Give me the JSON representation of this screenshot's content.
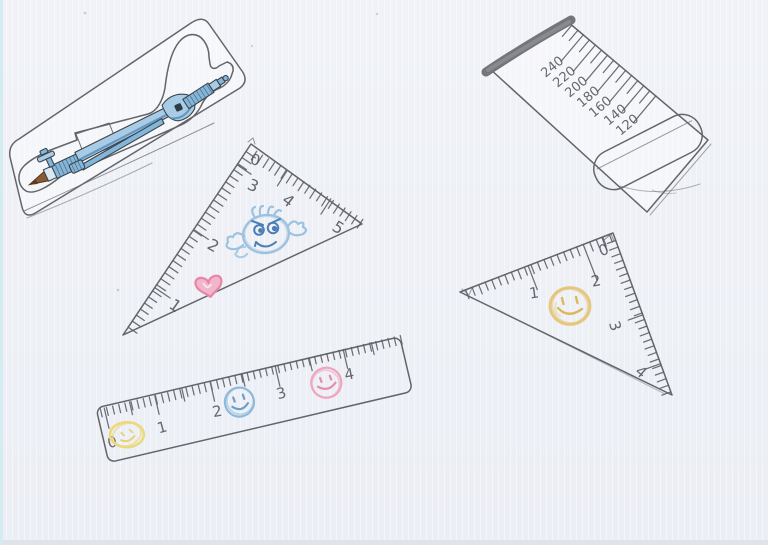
{
  "canvas": {
    "width": 768,
    "height": 545
  },
  "colors": {
    "paper": "#eef0f5",
    "graphite_pencil": "#64646b",
    "compass_blue": "#84b6da",
    "compass_blue_light": "#a9cce6",
    "compass_blue_shade": "#5589b8",
    "pencil_tip_brown": "#8a5a32",
    "roller_edge_gray": "#74747b",
    "doodle_face_blue": "#9cc2e0",
    "doodle_face_blue_dark": "#4a7fb5",
    "heart_pink_stroke": "#e884a8",
    "heart_pink_fill": "#f2b6ca",
    "smiley_orange": "#e4c06a",
    "smiley_yellow": "#ecd97e",
    "smiley_blue": "#8fb9db",
    "smiley_pink": "#efa5be"
  },
  "objects": {
    "roller_ruler": {
      "scale_labels": [
        "240",
        "220",
        "200",
        "180",
        "160",
        "140",
        "120"
      ]
    },
    "left_triangle_ruler": {
      "apex_label": "0",
      "edge_labels": [
        "3",
        "2",
        "1"
      ],
      "top_labels": [
        "4",
        "5"
      ]
    },
    "right_triangle_ruler": {
      "corner_label": "0",
      "top_labels": [
        "1",
        "2"
      ],
      "side_labels": [
        "3",
        "4"
      ]
    },
    "straight_ruler": {
      "scale_labels": [
        "0",
        "1",
        "2",
        "3",
        "4"
      ]
    }
  }
}
